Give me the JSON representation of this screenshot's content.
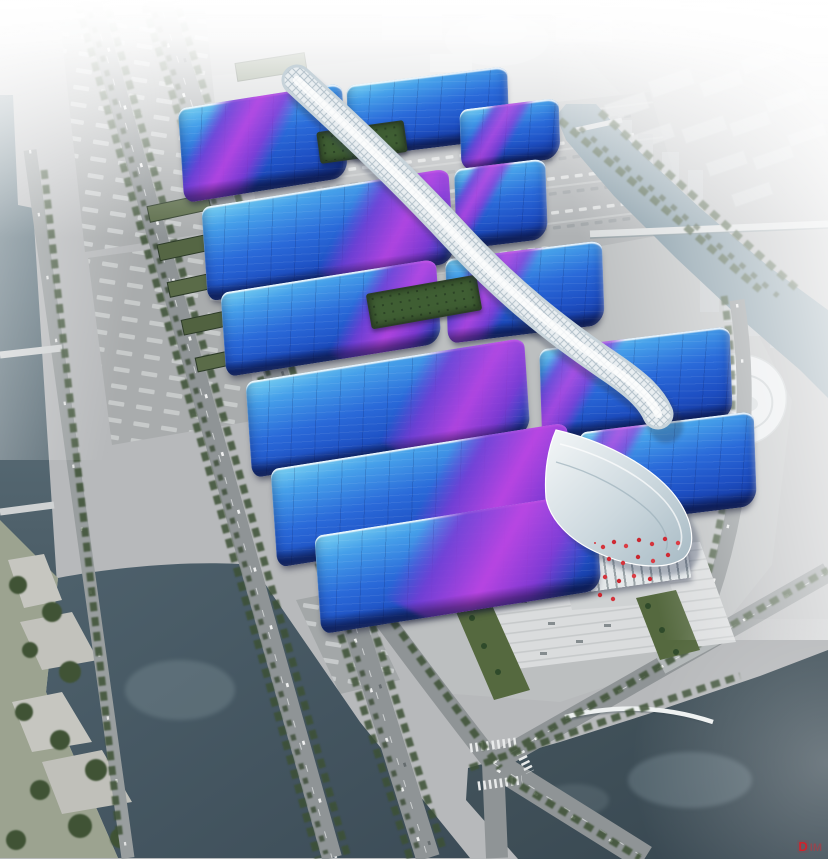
{
  "meta": {
    "description": "Aerial architectural rendering of a riverside exhibition and convention center: parallel rows of wave-shaped blue roofs with sweeping purple ribbon stripes, joined by a white lattice central corridor that ends in a silver wave entrance canopy and flag-lined plaza, surrounded by tree-lined boulevards, canals, a lake, parking and truck depots, with a hazy white city skyline beyond."
  },
  "watermark": {
    "primary": "D",
    "secondary": "IM"
  },
  "palette": {
    "roof_cyan": "#7cd4f2",
    "roof_blue": "#2a6ad9",
    "roof_deep_blue": "#16399f",
    "ribbon_purple": "#7a3cd6",
    "ribbon_magenta": "#bc44e2",
    "corridor_white": "#e9eef1",
    "canopy_silver": "#c3d0d7",
    "ground_gray": "#b7b9bb",
    "road_gray": "#8f9496",
    "water_dark": "#3f505b",
    "water_canal": "#7e95a1",
    "tree_green": "#3d5135",
    "lawn_green": "#7d9455",
    "fog_white": "#ffffff",
    "flag_red": "#d4343c"
  },
  "scene": {
    "elements": [
      "exhibition-hall-roofs",
      "central-corridor",
      "entrance-wave-canopy",
      "entrance-plaza",
      "flag-cluster",
      "roof-gardens",
      "twin-boulevards",
      "right-canal",
      "left-river",
      "lake",
      "parkland",
      "parking-lot",
      "truck-depots",
      "green-roof-warehouses",
      "city-skyline",
      "dome-building",
      "landmark-building",
      "pedestrian-arc-bridge",
      "road-bridges"
    ]
  }
}
